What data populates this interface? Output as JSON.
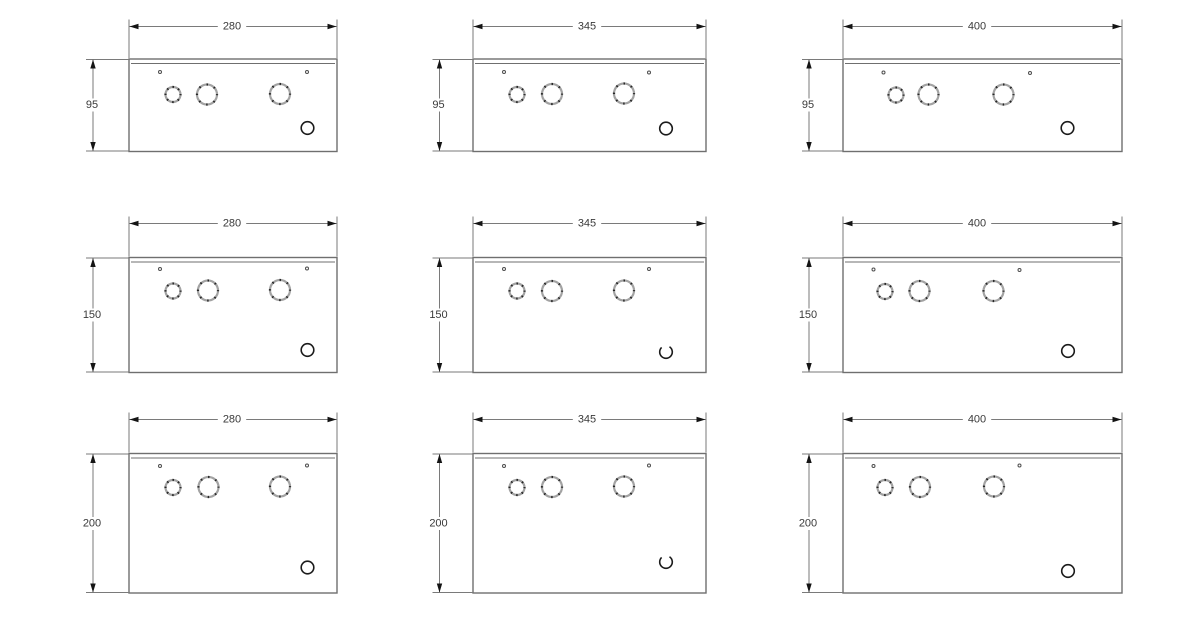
{
  "canvas": {
    "width": 1200,
    "height": 633,
    "background": "#ffffff"
  },
  "colors": {
    "background": "#ffffff",
    "outline": "#6f6f6f",
    "dim_line": "#7a7a7a",
    "arrow": "#141414",
    "dim_text": "#3a3a3a",
    "knockout_ring": "#a3a3a3",
    "knockout_tick": "#262626",
    "pilot_dot": "#4d4d4d",
    "corner_hole": "#1b1b1b",
    "panel_fill": "#ffffff"
  },
  "styles": {
    "outline_width": 1.4,
    "flange_width": 1,
    "flange_offset": 4.5,
    "dim_width": 1,
    "knockout_stroke": 2.2,
    "corner_hole_stroke": 1.6,
    "pilot_radius": 1.5,
    "font_size": 11,
    "arrow_len": 9,
    "arrow_half": 2.7,
    "ext_overshoot": 7
  },
  "drawings": [
    {
      "name": "panel-280x95",
      "width_label": "280",
      "height_label": "95",
      "box": {
        "left": 129,
        "top": 59,
        "right": 337,
        "bottom": 151.5
      },
      "dim_h": {
        "y": 26.5,
        "cx": 232
      },
      "dim_v": {
        "x": 93,
        "cy": 105
      },
      "pilot_dots": [
        {
          "x": 160,
          "y": 72
        },
        {
          "x": 307,
          "y": 72
        }
      ],
      "knockouts": [
        {
          "x": 173,
          "y": 94.5,
          "r": 7.5
        },
        {
          "x": 207,
          "y": 94.5,
          "r": 10
        },
        {
          "x": 280,
          "y": 94,
          "r": 10
        }
      ],
      "corner_hole": {
        "x": 307.5,
        "y": 128,
        "r": 6.3,
        "open_top": false
      }
    },
    {
      "name": "panel-345x95",
      "width_label": "345",
      "height_label": "95",
      "box": {
        "left": 473,
        "top": 59,
        "right": 706,
        "bottom": 151.5
      },
      "dim_h": {
        "y": 26.5,
        "cx": 587
      },
      "dim_v": {
        "x": 439.5,
        "cy": 105
      },
      "pilot_dots": [
        {
          "x": 504,
          "y": 72
        },
        {
          "x": 649,
          "y": 72.5
        }
      ],
      "knockouts": [
        {
          "x": 517,
          "y": 94.5,
          "r": 7.5
        },
        {
          "x": 552,
          "y": 94,
          "r": 10
        },
        {
          "x": 624,
          "y": 93.5,
          "r": 10
        }
      ],
      "corner_hole": {
        "x": 666,
        "y": 128.5,
        "r": 6.3,
        "open_top": false
      }
    },
    {
      "name": "panel-400x95",
      "width_label": "400",
      "height_label": "95",
      "box": {
        "left": 843,
        "top": 59,
        "right": 1122,
        "bottom": 151.5
      },
      "dim_h": {
        "y": 26.5,
        "cx": 977
      },
      "dim_v": {
        "x": 809,
        "cy": 105
      },
      "pilot_dots": [
        {
          "x": 883.5,
          "y": 72.5
        },
        {
          "x": 1030,
          "y": 73
        }
      ],
      "knockouts": [
        {
          "x": 896,
          "y": 95,
          "r": 7.5
        },
        {
          "x": 928.5,
          "y": 94.5,
          "r": 10
        },
        {
          "x": 1003.5,
          "y": 94.5,
          "r": 10
        }
      ],
      "corner_hole": {
        "x": 1067.5,
        "y": 128,
        "r": 6.3,
        "open_top": false
      }
    },
    {
      "name": "panel-280x150",
      "width_label": "280",
      "height_label": "150",
      "box": {
        "left": 129,
        "top": 257.5,
        "right": 337,
        "bottom": 372.5
      },
      "dim_h": {
        "y": 223.5,
        "cx": 232
      },
      "dim_v": {
        "x": 93,
        "cy": 315
      },
      "pilot_dots": [
        {
          "x": 160,
          "y": 269
        },
        {
          "x": 307,
          "y": 268.5
        }
      ],
      "knockouts": [
        {
          "x": 173,
          "y": 291,
          "r": 7.5
        },
        {
          "x": 208,
          "y": 290.5,
          "r": 10
        },
        {
          "x": 280,
          "y": 290,
          "r": 10
        }
      ],
      "corner_hole": {
        "x": 307.5,
        "y": 350,
        "r": 6.3,
        "open_top": false
      }
    },
    {
      "name": "panel-345x150",
      "width_label": "345",
      "height_label": "150",
      "box": {
        "left": 473,
        "top": 257.5,
        "right": 706,
        "bottom": 372.5
      },
      "dim_h": {
        "y": 223.5,
        "cx": 587
      },
      "dim_v": {
        "x": 439.5,
        "cy": 315
      },
      "pilot_dots": [
        {
          "x": 504,
          "y": 269
        },
        {
          "x": 649,
          "y": 269
        }
      ],
      "knockouts": [
        {
          "x": 517,
          "y": 291,
          "r": 7.5
        },
        {
          "x": 552,
          "y": 291,
          "r": 10
        },
        {
          "x": 624,
          "y": 290.5,
          "r": 10
        }
      ],
      "corner_hole": {
        "x": 666,
        "y": 352,
        "r": 6.3,
        "open_top": true
      }
    },
    {
      "name": "panel-400x150",
      "width_label": "400",
      "height_label": "150",
      "box": {
        "left": 843,
        "top": 257.5,
        "right": 1122,
        "bottom": 372.5
      },
      "dim_h": {
        "y": 223.5,
        "cx": 977
      },
      "dim_v": {
        "x": 809,
        "cy": 315
      },
      "pilot_dots": [
        {
          "x": 873.5,
          "y": 269.5
        },
        {
          "x": 1019.5,
          "y": 270
        }
      ],
      "knockouts": [
        {
          "x": 885,
          "y": 291.5,
          "r": 7.5
        },
        {
          "x": 919.5,
          "y": 291,
          "r": 10
        },
        {
          "x": 993.5,
          "y": 291,
          "r": 10
        }
      ],
      "corner_hole": {
        "x": 1068,
        "y": 351,
        "r": 6.3,
        "open_top": false
      }
    },
    {
      "name": "panel-280x200",
      "width_label": "280",
      "height_label": "200",
      "box": {
        "left": 129,
        "top": 453.5,
        "right": 337,
        "bottom": 593
      },
      "dim_h": {
        "y": 419.5,
        "cx": 232
      },
      "dim_v": {
        "x": 93,
        "cy": 523.5
      },
      "pilot_dots": [
        {
          "x": 160,
          "y": 466
        },
        {
          "x": 307,
          "y": 465.5
        }
      ],
      "knockouts": [
        {
          "x": 173,
          "y": 487.5,
          "r": 7.5
        },
        {
          "x": 208.5,
          "y": 487,
          "r": 10
        },
        {
          "x": 280,
          "y": 486.5,
          "r": 10
        }
      ],
      "corner_hole": {
        "x": 307.5,
        "y": 567.5,
        "r": 6.3,
        "open_top": false
      }
    },
    {
      "name": "panel-345x200",
      "width_label": "345",
      "height_label": "200",
      "box": {
        "left": 473,
        "top": 453.5,
        "right": 706,
        "bottom": 593
      },
      "dim_h": {
        "y": 419.5,
        "cx": 587
      },
      "dim_v": {
        "x": 439.5,
        "cy": 523.5
      },
      "pilot_dots": [
        {
          "x": 504,
          "y": 466
        },
        {
          "x": 649,
          "y": 465.5
        }
      ],
      "knockouts": [
        {
          "x": 517,
          "y": 487.5,
          "r": 7.5
        },
        {
          "x": 552,
          "y": 487,
          "r": 10
        },
        {
          "x": 624,
          "y": 486.5,
          "r": 10
        }
      ],
      "corner_hole": {
        "x": 666,
        "y": 562,
        "r": 6.3,
        "open_top": true
      }
    },
    {
      "name": "panel-400x200",
      "width_label": "400",
      "height_label": "200",
      "box": {
        "left": 843,
        "top": 453.5,
        "right": 1122,
        "bottom": 593
      },
      "dim_h": {
        "y": 419.5,
        "cx": 977
      },
      "dim_v": {
        "x": 809,
        "cy": 523.5
      },
      "pilot_dots": [
        {
          "x": 873.5,
          "y": 466
        },
        {
          "x": 1019.5,
          "y": 465.5
        }
      ],
      "knockouts": [
        {
          "x": 885,
          "y": 487.5,
          "r": 7.5
        },
        {
          "x": 920,
          "y": 487,
          "r": 10
        },
        {
          "x": 994,
          "y": 486.5,
          "r": 10
        }
      ],
      "corner_hole": {
        "x": 1068,
        "y": 571,
        "r": 6.3,
        "open_top": false
      }
    }
  ]
}
